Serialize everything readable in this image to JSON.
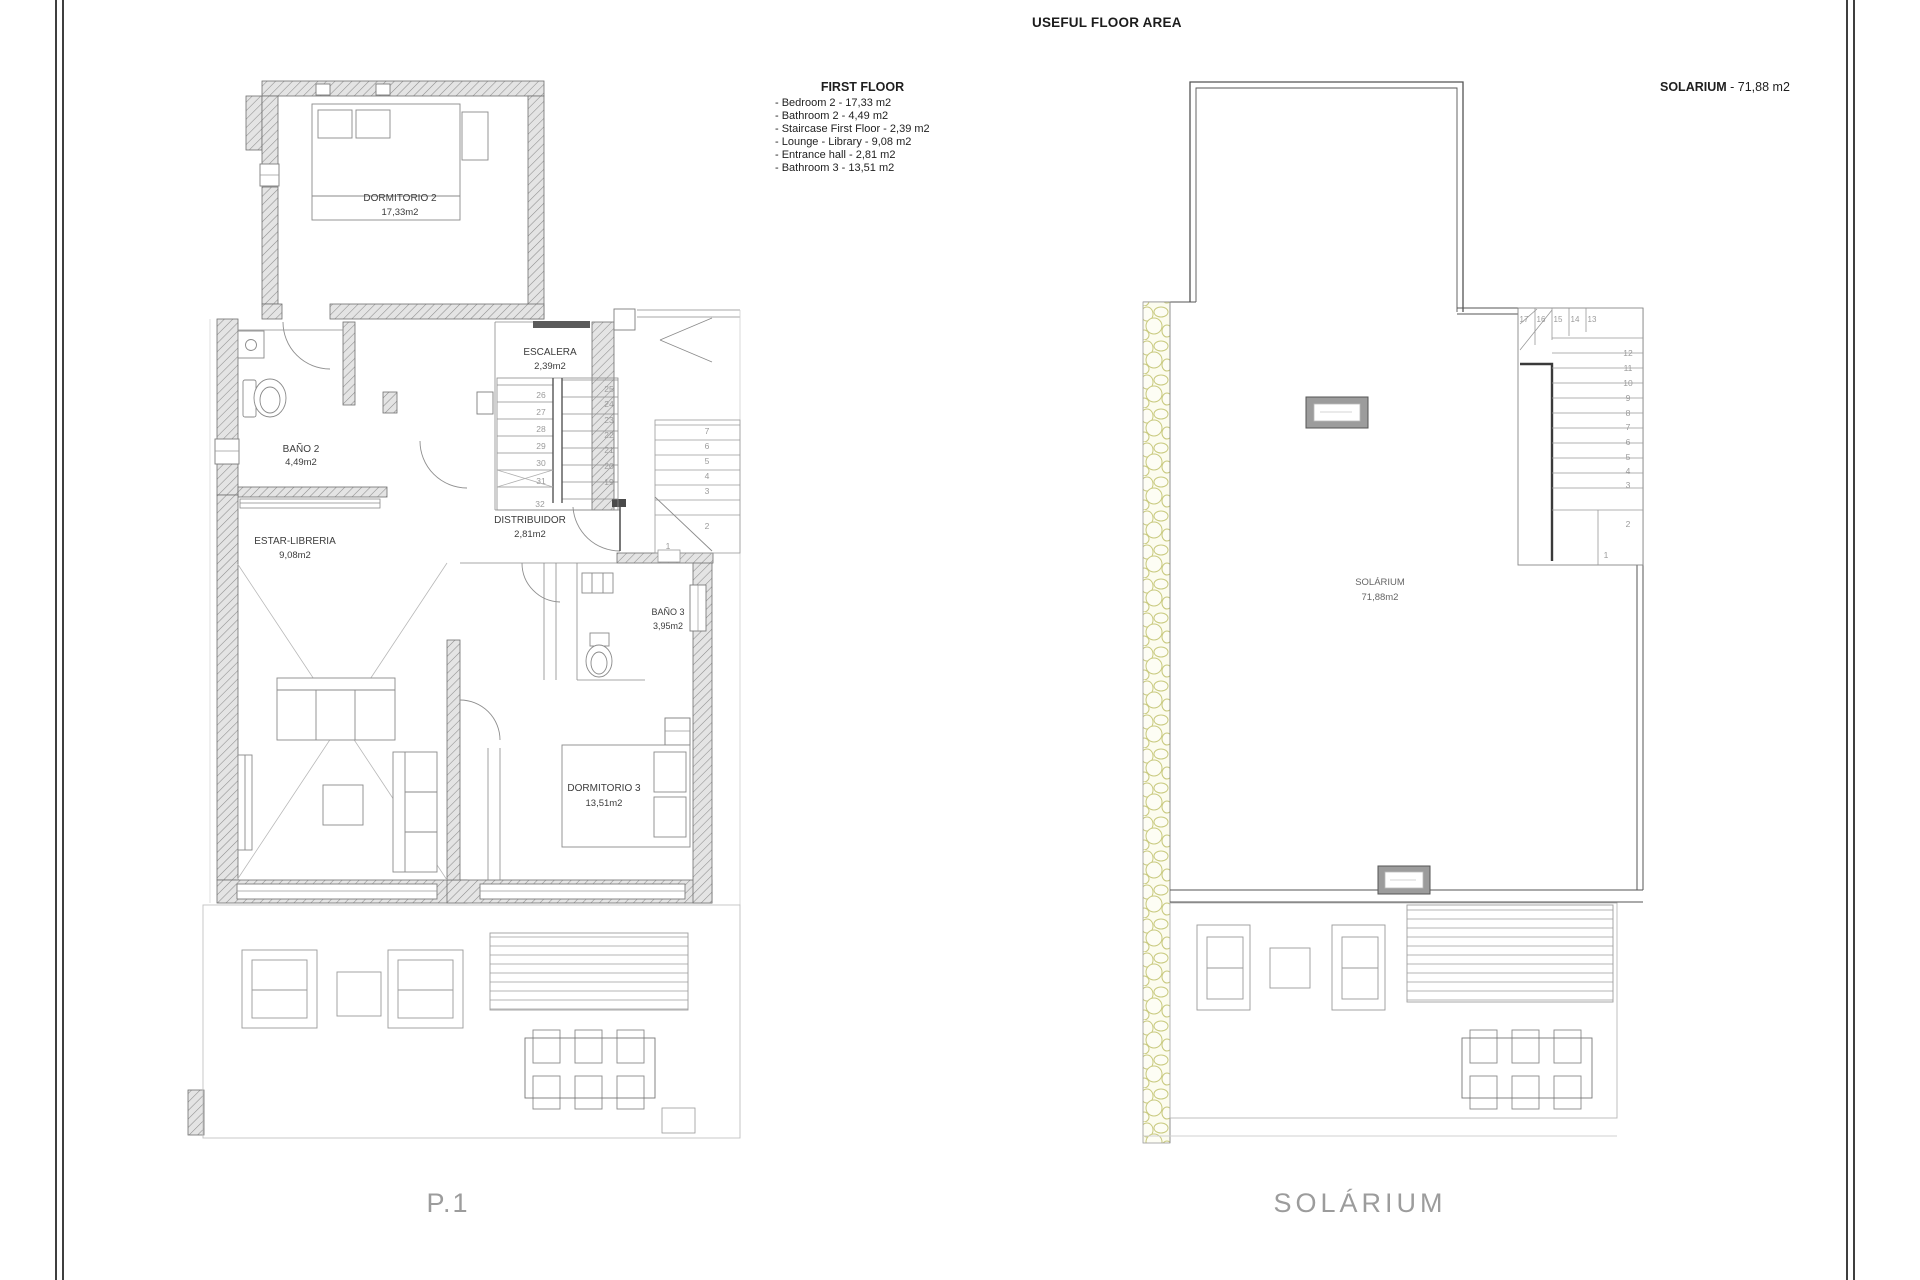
{
  "sheet": {
    "title": "USEFUL FLOOR AREA",
    "colors": {
      "stone_accent": "#c9ca7f",
      "wall_fill": "#e4e4e4",
      "frame_line": "#3f3f3f"
    }
  },
  "legend": {
    "heading": "FIRST FLOOR",
    "items": [
      "- Bedroom 2 - 17,33 m2",
      "- Bathroom 2 - 4,49 m2",
      "- Staircase First Floor - 2,39 m2",
      "- Lounge - Library - 9,08 m2",
      "- Entrance hall - 2,81 m2",
      "- Bathroom 3 - 13,51 m2"
    ]
  },
  "solarium_note": {
    "label": "SOLARIUM",
    "value": " - 71,88 m2"
  },
  "left_plan": {
    "caption": "P.1",
    "rooms": {
      "dormitorio2": {
        "name": "DORMITORIO 2",
        "area": "17,33m2"
      },
      "bano2": {
        "name": "BAÑO 2",
        "area": "4,49m2"
      },
      "escalera": {
        "name": "ESCALERA",
        "area": "2,39m2"
      },
      "distribuidor": {
        "name": "DISTRIBUIDOR",
        "area": "2,81m2"
      },
      "estar": {
        "name": "ESTAR-LIBRERIA",
        "area": "9,08m2"
      },
      "bano3": {
        "name": "BAÑO 3",
        "area": "3,95m2"
      },
      "dormitorio3": {
        "name": "DORMITORIO 3",
        "area": "13,51m2"
      }
    },
    "stairs": {
      "flight_a": [
        "26",
        "27",
        "28",
        "29",
        "30",
        "31"
      ],
      "flight_b": [
        "25",
        "24",
        "23",
        "22",
        "21",
        "20",
        "19"
      ],
      "mid_step": "32",
      "entry": [
        "7",
        "6",
        "5",
        "4",
        "3",
        "2",
        "1"
      ]
    }
  },
  "right_plan": {
    "caption": "SOLÁRIUM",
    "room": {
      "name": "SOLÁRIUM",
      "area": "71,88m2"
    },
    "stairs": {
      "winders": [
        "17",
        "16",
        "15",
        "14",
        "13"
      ],
      "flight": [
        "12",
        "11",
        "10",
        "9",
        "8",
        "7",
        "6",
        "5",
        "4",
        "3",
        "2",
        "1"
      ]
    }
  }
}
